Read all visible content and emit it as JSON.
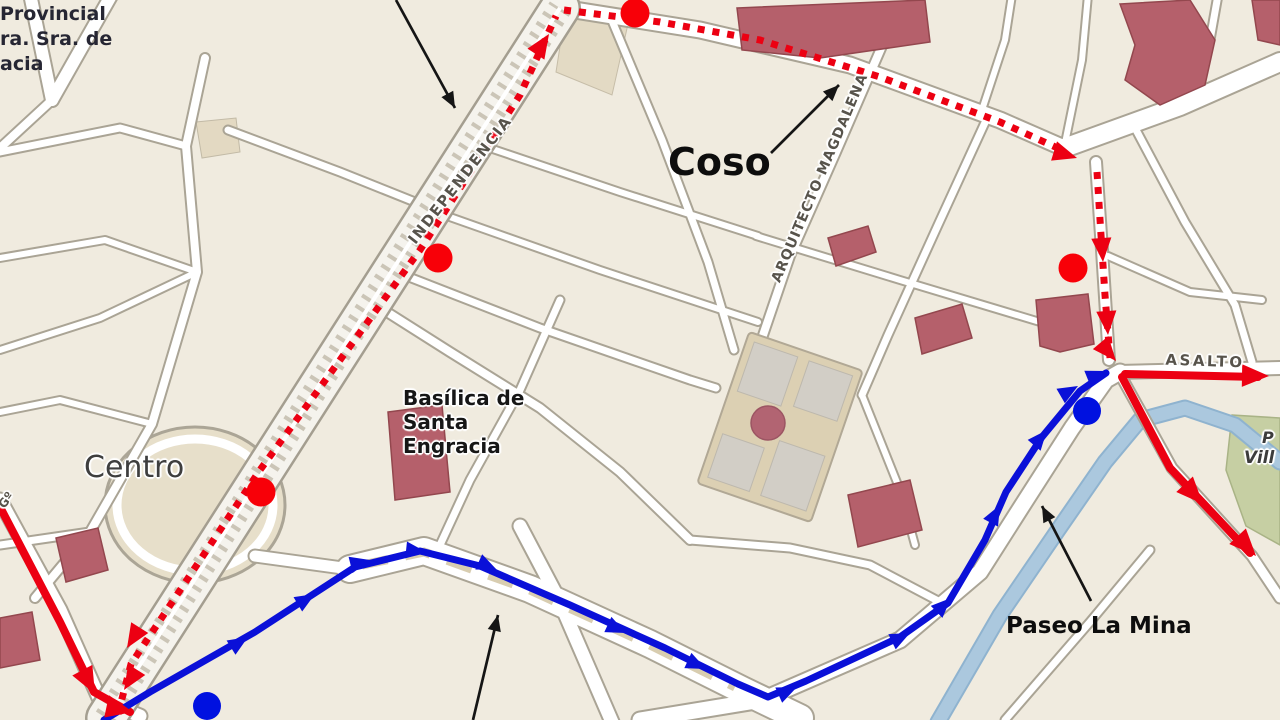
{
  "map": {
    "colors": {
      "route_red": "#ec0012",
      "route_blue": "#0a10d8",
      "stop_red": "#f80008",
      "stop_blue": "#0011e0",
      "annotation": "#151515"
    },
    "place_labels": {
      "topleft_line1": "Provincial",
      "topleft_line2": "ra. Sra. de",
      "topleft_line3": "acia",
      "centro": "Centro",
      "coso": "Coso",
      "basilica_line1": "Basílica de",
      "basilica_line2": "Santa",
      "basilica_line3": "Engracia",
      "paseo_la_mina": "Paseo La Mina",
      "right_fragment1": "P",
      "right_fragment2": "Vill"
    },
    "street_labels": {
      "independencia": "INDEPENDENCIA",
      "arquitecto_magdalena": "ARQUITECTO MAGDALENA",
      "paseo_constitucion": "PASEO CONSTITUCION",
      "asalto": "ASALTO",
      "left_fragment": "Gº"
    },
    "routes": {
      "red_dotted": {
        "style": "dotted",
        "width": 7,
        "dash": "7 8",
        "segments": [
          [
            [
              118,
              714
            ],
            [
              131,
              664
            ],
            [
              260,
              470
            ],
            [
              420,
              250
            ],
            [
              520,
              95
            ],
            [
              556,
              16
            ]
          ],
          [
            [
              564,
              10
            ],
            [
              660,
              22
            ],
            [
              760,
              40
            ],
            [
              880,
              77
            ],
            [
              1000,
              122
            ],
            [
              1062,
              150
            ]
          ],
          [
            [
              1097,
              172
            ],
            [
              1101,
              235
            ],
            [
              1105,
              295
            ],
            [
              1110,
              358
            ]
          ]
        ]
      },
      "red_solid": {
        "style": "solid",
        "width": 8,
        "segments": [
          [
            [
              0,
              507
            ],
            [
              60,
              622
            ],
            [
              94,
              692
            ],
            [
              130,
              712
            ]
          ],
          [
            [
              1125,
              374
            ],
            [
              1258,
              377
            ]
          ],
          [
            [
              1122,
              377
            ],
            [
              1170,
              468
            ],
            [
              1250,
              553
            ]
          ]
        ]
      },
      "blue": {
        "style": "solid",
        "width": 7,
        "segments": [
          [
            [
              104,
              720
            ],
            [
              150,
              692
            ],
            [
              255,
              632
            ],
            [
              355,
              567
            ],
            [
              420,
              551
            ],
            [
              480,
              566
            ],
            [
              570,
              605
            ],
            [
              665,
              648
            ],
            [
              738,
              684
            ],
            [
              768,
              697
            ],
            [
              806,
              681
            ],
            [
              900,
              637
            ],
            [
              948,
              603
            ],
            [
              985,
              540
            ],
            [
              1006,
              492
            ],
            [
              1042,
              437
            ],
            [
              1080,
              391
            ],
            [
              1106,
              373
            ]
          ]
        ]
      }
    },
    "route_arrowheads": {
      "red_dotted": [
        [
          127,
          648,
          122
        ],
        [
          124,
          690,
          122
        ],
        [
          549,
          34,
          -57
        ],
        [
          1077,
          158,
          17
        ],
        [
          1103,
          262,
          86
        ],
        [
          1108,
          335,
          86
        ],
        [
          1116,
          361,
          50
        ]
      ],
      "red_solid": [
        [
          95,
          694,
          62
        ],
        [
          133,
          712,
          12
        ],
        [
          1269,
          376,
          1
        ],
        [
          1203,
          504,
          47
        ],
        [
          1256,
          556,
          47
        ]
      ],
      "blue": [
        [
          248,
          637,
          -32
        ],
        [
          315,
          594,
          -31
        ],
        [
          370,
          560,
          -14
        ],
        [
          426,
          552,
          6
        ],
        [
          497,
          570,
          24
        ],
        [
          626,
          633,
          25
        ],
        [
          706,
          669,
          25
        ],
        [
          797,
          687,
          -24
        ],
        [
          910,
          633,
          -26
        ],
        [
          951,
          598,
          -44
        ],
        [
          1000,
          505,
          -62
        ],
        [
          1047,
          430,
          -50
        ],
        [
          1078,
          386,
          -30
        ],
        [
          1106,
          371,
          -22
        ]
      ]
    },
    "stops": {
      "red": [
        [
          635,
          13
        ],
        [
          438,
          258
        ],
        [
          261,
          492
        ],
        [
          1073,
          268
        ]
      ],
      "blue": [
        [
          207,
          706
        ],
        [
          1087,
          411
        ]
      ]
    },
    "annotation_arrows": [
      {
        "x1": 396,
        "y1": 0,
        "x2": 455,
        "y2": 108
      },
      {
        "x1": 771,
        "y1": 153,
        "x2": 839,
        "y2": 85
      },
      {
        "x1": 1091,
        "y1": 601,
        "x2": 1042,
        "y2": 506
      },
      {
        "x1": 473,
        "y1": 720,
        "x2": 498,
        "y2": 615
      }
    ]
  }
}
